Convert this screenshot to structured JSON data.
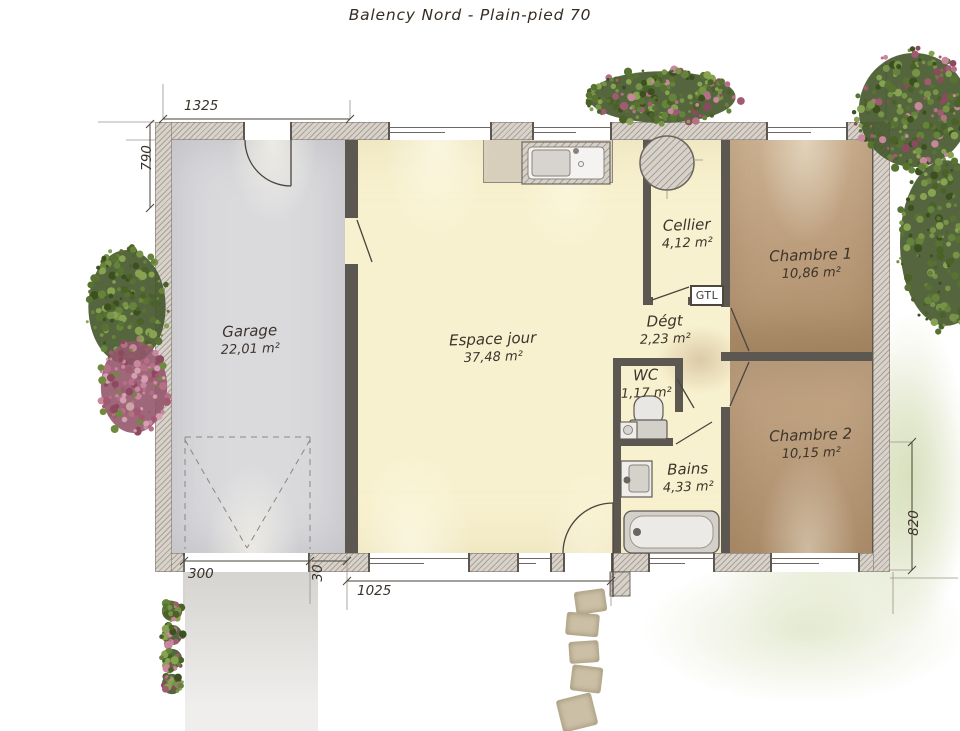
{
  "title": "Balency Nord - Plain-pied 70",
  "rooms": {
    "garage": {
      "name": "Garage",
      "area": "22,01 m²"
    },
    "espace_jour": {
      "name": "Espace jour",
      "area": "37,48 m²"
    },
    "cellier": {
      "name": "Cellier",
      "area": "4,12 m²"
    },
    "degagement": {
      "name": "Dégt",
      "area": "2,23 m²"
    },
    "wc": {
      "name": "WC",
      "area": "1,17 m²"
    },
    "bains": {
      "name": "Bains",
      "area": "4,33 m²"
    },
    "chambre1": {
      "name": "Chambre 1",
      "area": "10,86 m²"
    },
    "chambre2": {
      "name": "Chambre 2",
      "area": "10,15 m²"
    }
  },
  "annotations": {
    "gtl": "GTL"
  },
  "dimensions": {
    "top_left": "1325",
    "left": "790",
    "garage_door": "300",
    "pier": "30",
    "facade": "1025",
    "right": "820"
  },
  "colors": {
    "floor_cream": "#f8f1cf",
    "floor_garage": "#dadadd",
    "floor_bedroom": "#c2a384",
    "wall_hatch": "#d8d2ca",
    "wall_dark": "#5d5751",
    "line": "#4b443d",
    "vegetation_green": "#587232",
    "flower_pink": "#b76f88",
    "lawn_wash": "#d5ddb7",
    "driveway": "#d7d5d2",
    "stone": "#cbc0a6"
  }
}
